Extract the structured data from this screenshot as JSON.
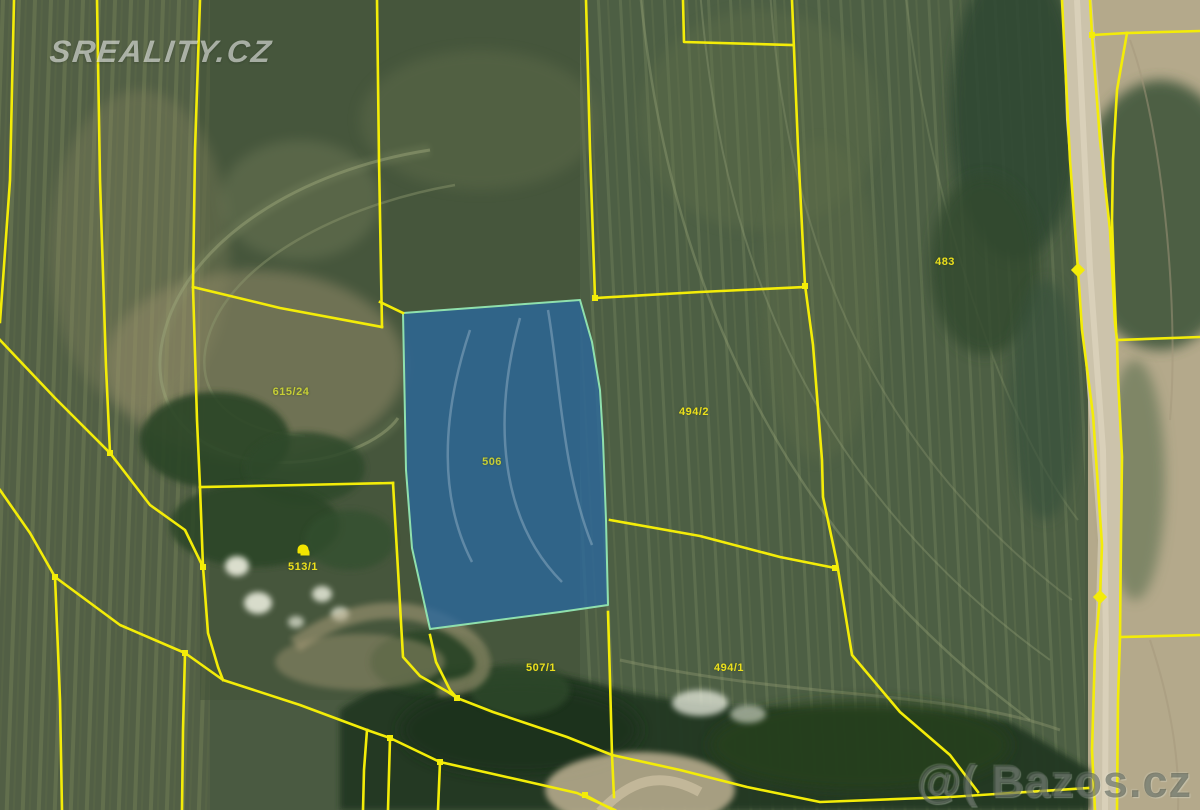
{
  "map": {
    "type": "cadastral-aerial-overlay",
    "width": 1200,
    "height": 810,
    "boundary_color": "#f3ec08",
    "boundary_width": 2.6
  },
  "watermarks": {
    "top_left": "SREALITY.CZ",
    "bottom_right": "@( Bazos.cz"
  },
  "highlight": {
    "parcel_number": "506",
    "fill": "rgba(42,104,158,0.78)",
    "stroke": "#8fe0ad",
    "stroke_width": 2,
    "points": "403,313 580,300 592,342 600,390 603,440 606,520 608,605 560,612 430,629 412,548 406,470"
  },
  "parcel_labels": [
    {
      "text": "483",
      "x": 945,
      "y": 262,
      "muted": false
    },
    {
      "text": "494/2",
      "x": 694,
      "y": 412,
      "muted": false
    },
    {
      "text": "506",
      "x": 492,
      "y": 462,
      "muted": true
    },
    {
      "text": "615/24",
      "x": 291,
      "y": 392,
      "muted": true
    },
    {
      "text": "513/1",
      "x": 303,
      "y": 567,
      "muted": false,
      "symbol": {
        "x": 303,
        "y": 549
      }
    },
    {
      "text": "507/1",
      "x": 541,
      "y": 668,
      "muted": false
    },
    {
      "text": "494/1",
      "x": 729,
      "y": 668,
      "muted": false
    }
  ],
  "boundaries": [
    {
      "id": "left-edge-line",
      "points": "14,0 10,180 3,280 0,322"
    },
    {
      "id": "second-vertical",
      "points": "97,0 100,180 106,367 110,453"
    },
    {
      "id": "diagonal-upper-left",
      "points": "0,340 55,398 110,453"
    },
    {
      "id": "diagonal-to-grove",
      "points": "110,453 150,505 185,530 203,567"
    },
    {
      "id": "third-vertical",
      "points": "200,0 195,150 193,287 197,420 200,487"
    },
    {
      "id": "grove-left-curve",
      "points": "200,487 203,567 208,633 218,667 223,680"
    },
    {
      "id": "cross-diagonal",
      "points": "193,287 280,308 382,327"
    },
    {
      "id": "fourth-vertical",
      "points": "377,0 379,160 382,327"
    },
    {
      "id": "link-to-blue-corner",
      "points": "380,302 403,313"
    },
    {
      "id": "grove-top-edge",
      "points": "200,487 300,485 393,483"
    },
    {
      "id": "grove-right-edge",
      "points": "393,483 398,570 403,657 420,676 448,692 457,698"
    },
    {
      "id": "blue-bottom-link",
      "points": "430,635 436,662 450,690 457,698"
    },
    {
      "id": "forest-upper-diagonal",
      "points": "457,698 493,712 567,737 612,755 680,770 747,787 820,802 950,797 1088,788"
    },
    {
      "id": "forest-lower-diagonal",
      "points": "0,490 30,533 55,577 120,625 185,653 223,680 300,705 367,730 390,738 440,762 520,780 577,793 615,810"
    },
    {
      "id": "drop-1",
      "points": "55,577 60,700 62,810"
    },
    {
      "id": "drop-2",
      "points": "185,653 183,730 182,810"
    },
    {
      "id": "drop-3",
      "points": "367,730 364,770 363,810"
    },
    {
      "id": "drop-4",
      "points": "390,738 388,810"
    },
    {
      "id": "drop-5",
      "points": "440,762 438,810"
    },
    {
      "id": "mid-vertical-507-494",
      "points": "608,612 610,680 612,755 614,797"
    },
    {
      "id": "small-branch",
      "points": "585,795 613,810"
    },
    {
      "id": "top-mid-vertical",
      "points": "586,0 590,150 595,298"
    },
    {
      "id": "horizontal-above-blue",
      "points": "595,298 700,292 805,287"
    },
    {
      "id": "right-field-vertical",
      "points": "792,0 798,147 803,247 805,285"
    },
    {
      "id": "top-stub-connector",
      "points": "683,0 684,42 792,45"
    },
    {
      "id": "long-right-diagonal",
      "points": "805,285 813,345 822,460 823,497 837,563 852,655 900,712 950,755 978,792"
    },
    {
      "id": "link-blue-to-right",
      "points": "610,520 700,536 780,557 835,568"
    },
    {
      "id": "road-left-edge",
      "points": "1062,0 1070,160 1078,270 1082,330 1093,415 1098,487 1102,545 1100,597 1095,650 1092,750 1095,810"
    },
    {
      "id": "road-right-edge",
      "points": "1090,0 1092,35 1100,140 1110,230 1115,323 1117,340 1118,377 1122,457 1121,535 1120,637 1118,700 1117,810"
    },
    {
      "id": "road-right-parallel",
      "points": "1127,33 1117,90 1113,160 1112,220 1114,280 1116,330"
    },
    {
      "id": "road-top-connector",
      "points": "1092,35 1110,34 1127,33"
    },
    {
      "id": "right-horizontal-top",
      "points": "1127,33 1200,31"
    },
    {
      "id": "right-horizontal-mid",
      "points": "1117,340 1200,337"
    },
    {
      "id": "right-horizontal-low",
      "points": "1120,637 1200,635"
    }
  ],
  "survey_markers": [
    {
      "x": 1078,
      "y": 270,
      "shape": "diamond"
    },
    {
      "x": 1100,
      "y": 597,
      "shape": "diamond"
    }
  ],
  "junction_nodes": [
    {
      "x": 110,
      "y": 453
    },
    {
      "x": 203,
      "y": 567
    },
    {
      "x": 55,
      "y": 577
    },
    {
      "x": 185,
      "y": 653
    },
    {
      "x": 457,
      "y": 698
    },
    {
      "x": 390,
      "y": 738
    },
    {
      "x": 440,
      "y": 762
    },
    {
      "x": 585,
      "y": 795
    },
    {
      "x": 835,
      "y": 568
    },
    {
      "x": 595,
      "y": 298
    },
    {
      "x": 805,
      "y": 286
    },
    {
      "x": 1092,
      "y": 35
    }
  ]
}
